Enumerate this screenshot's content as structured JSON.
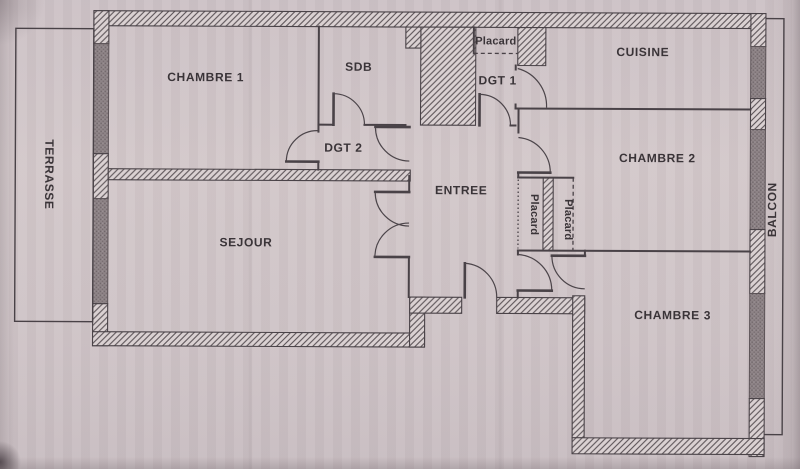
{
  "document": {
    "kind": "scanned apartment floor plan",
    "colors": {
      "paper": "#cfc4c7",
      "wall_line": "#494247",
      "hatch_background": "#dad1d2",
      "hatch_line": "#5b5357",
      "masonry_stipple": "#8e8487",
      "label_text": "#3a3438"
    }
  },
  "rooms": [
    {
      "id": "terrasse",
      "label": "TERRASSE",
      "orientation": "vertical-top-to-bottom"
    },
    {
      "id": "chambre-1",
      "label": "CHAMBRE 1",
      "orientation": "horizontal"
    },
    {
      "id": "sdb",
      "label": "SDB",
      "orientation": "horizontal"
    },
    {
      "id": "placard-haut",
      "label": "Placard",
      "orientation": "horizontal"
    },
    {
      "id": "dgt-1",
      "label": "DGT 1",
      "orientation": "horizontal"
    },
    {
      "id": "cuisine",
      "label": "CUISINE",
      "orientation": "horizontal"
    },
    {
      "id": "dgt-2",
      "label": "DGT 2",
      "orientation": "horizontal"
    },
    {
      "id": "chambre-2",
      "label": "CHAMBRE 2",
      "orientation": "horizontal"
    },
    {
      "id": "entree",
      "label": "ENTREE",
      "orientation": "horizontal"
    },
    {
      "id": "placard-gauche",
      "label": "Placard",
      "orientation": "vertical-top-to-bottom"
    },
    {
      "id": "placard-droit",
      "label": "Placard",
      "orientation": "vertical-top-to-bottom"
    },
    {
      "id": "sejour",
      "label": "SEJOUR",
      "orientation": "horizontal"
    },
    {
      "id": "chambre-3",
      "label": "CHAMBRE 3",
      "orientation": "horizontal"
    },
    {
      "id": "balcon",
      "label": "BALCON",
      "orientation": "vertical-bottom-to-top"
    }
  ]
}
